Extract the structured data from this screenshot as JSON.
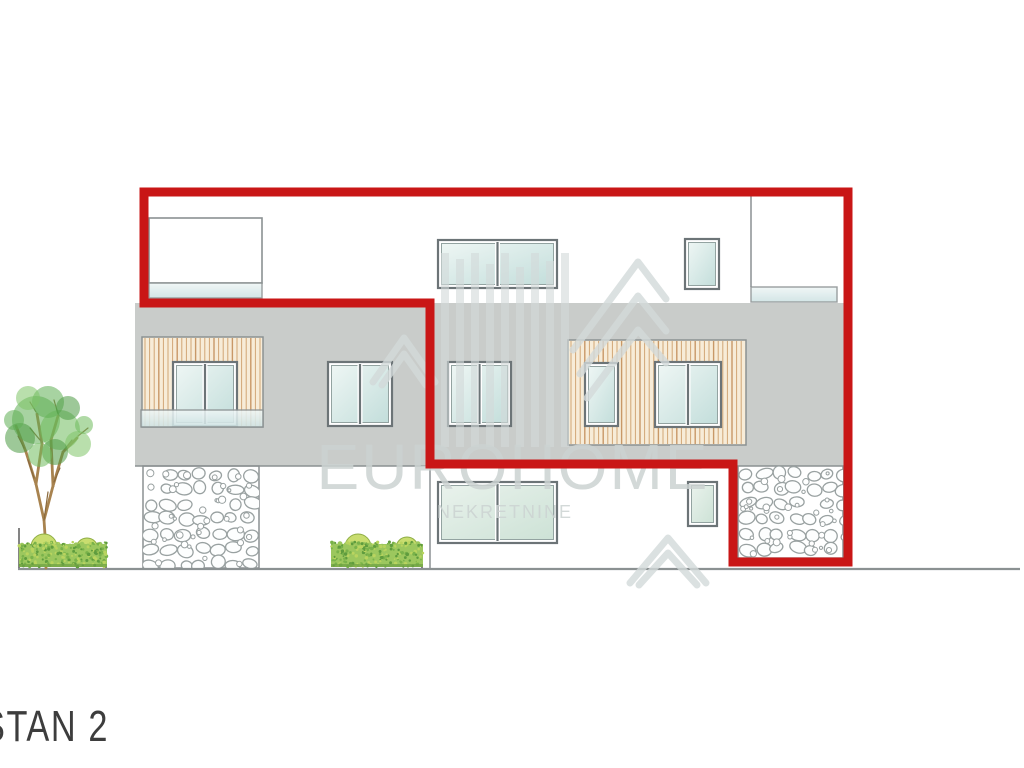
{
  "title_block": {
    "unit_label": "STAN 2"
  },
  "watermark": {
    "brand": "EUROHOME",
    "brand_sub": "NEKRETNINE"
  },
  "colors": {
    "red": "#c91616",
    "wall_gray": "#c9ccca",
    "wood_bg": "#f7ecd8",
    "wood_stripe": "#c58f55",
    "wood_stripe_dark": "#b97c42",
    "frame": "#6c7477",
    "line": "#8b9192",
    "stone": "#99a1a1",
    "dark_line": "#5a5a5a",
    "watermark_shape": "#d3dada",
    "hedge_base": "#9cc75e",
    "hedge_dark": "#5f9c3e",
    "hedge_light": "#b9d45f",
    "bush_fill": "#c9dd6f",
    "bush_stroke": "#8fae45",
    "trunk": "#a8834f",
    "twig": "#8a6a3e",
    "tree_greens": [
      "#5fae53",
      "#6fbb5d",
      "#4c9a44",
      "#7fc468"
    ]
  },
  "drawing": {
    "canvas": {
      "w": 1024,
      "h": 768
    },
    "walls": [
      {
        "name": "floor2-wall",
        "x": 135,
        "y": 303,
        "w": 710,
        "h": 163
      }
    ],
    "white_rects": [
      {
        "name": "attic-terrace-door",
        "x": 149,
        "y": 218,
        "w": 113,
        "h": 65
      }
    ],
    "wood_panels": [
      {
        "name": "wood-cladding-balcony",
        "x": 142,
        "y": 337,
        "w": 121,
        "h": 90
      },
      {
        "name": "wood-cladding-center",
        "x": 568,
        "y": 340,
        "w": 178,
        "h": 105
      }
    ],
    "windows": [
      {
        "name": "attic-window-center",
        "x": 438,
        "y": 240,
        "w": 119,
        "h": 48,
        "panes": 2,
        "glass": "g1"
      },
      {
        "name": "attic-window-small",
        "x": 685,
        "y": 239,
        "w": 34,
        "h": 50,
        "panes": 1,
        "glass": "g1"
      },
      {
        "name": "floor2-window-balcony",
        "x": 173,
        "y": 362,
        "w": 64,
        "h": 64,
        "panes": 2,
        "glass": "g1"
      },
      {
        "name": "floor2-window-left",
        "x": 328,
        "y": 362,
        "w": 64,
        "h": 64,
        "panes": 2,
        "glass": "g1"
      },
      {
        "name": "floor2-window-mid",
        "x": 448,
        "y": 362,
        "w": 63,
        "h": 64,
        "panes": 2,
        "glass": "g1"
      },
      {
        "name": "floor2-window-wood-small",
        "x": 585,
        "y": 363,
        "w": 33,
        "h": 63,
        "panes": 1,
        "glass": "g1"
      },
      {
        "name": "floor2-window-wood-large",
        "x": 655,
        "y": 362,
        "w": 66,
        "h": 65,
        "panes": 2,
        "glass": "g1"
      },
      {
        "name": "ground-window-large",
        "x": 438,
        "y": 482,
        "w": 119,
        "h": 61,
        "panes": 2,
        "glass": "g2"
      },
      {
        "name": "ground-window-small",
        "x": 688,
        "y": 482,
        "w": 29,
        "h": 44,
        "panes": 1,
        "glass": "g2"
      }
    ],
    "railings": [
      {
        "name": "glass-railing-attic-left",
        "x": 149,
        "y": 283,
        "w": 113,
        "h": 15
      },
      {
        "name": "glass-railing-attic-right",
        "x": 751,
        "y": 287,
        "w": 86,
        "h": 15
      },
      {
        "name": "glass-railing-balcony",
        "x": 141,
        "y": 410,
        "w": 122,
        "h": 17
      }
    ],
    "stones": [
      {
        "name": "stone-pillar-left",
        "x": 143,
        "y": 466,
        "w": 116,
        "h": 102
      },
      {
        "name": "stone-base-right",
        "x": 738,
        "y": 466,
        "w": 105,
        "h": 92
      }
    ],
    "lines": [
      {
        "name": "attic-divider-line",
        "x1": 751,
        "y1": 193,
        "x2": 751,
        "y2": 287,
        "w": 1.5
      },
      {
        "name": "floor-slab-edge-line",
        "x1": 135,
        "y1": 466,
        "x2": 426,
        "y2": 466,
        "w": 1.5
      },
      {
        "name": "ground-floor-corner-line",
        "x1": 430,
        "y1": 467,
        "x2": 430,
        "y2": 568,
        "w": 1.5
      },
      {
        "name": "ground-line",
        "x1": 18,
        "y1": 569,
        "x2": 1020,
        "y2": 569,
        "w": 2.2
      },
      {
        "name": "planter-edge-left",
        "x1": 19,
        "y1": 528,
        "x2": 19,
        "y2": 568,
        "w": 1.5,
        "color": "#5a5a5a"
      },
      {
        "name": "planter-edge-right",
        "x1": 106,
        "y1": 548,
        "x2": 106,
        "y2": 568,
        "w": 1.5,
        "color": "#5a5a5a"
      },
      {
        "name": "planter-edge-hedge2",
        "x1": 422,
        "y1": 548,
        "x2": 422,
        "y2": 568,
        "w": 1.5,
        "color": "#5a5a5a"
      }
    ],
    "tree": {
      "trunk": [
        [
          46,
          568,
          45,
          535
        ],
        [
          45,
          535,
          44,
          520
        ],
        [
          44,
          520,
          36,
          484
        ],
        [
          44,
          520,
          53,
          486
        ],
        [
          36,
          484,
          26,
          452
        ],
        [
          36,
          484,
          42,
          444
        ],
        [
          53,
          486,
          63,
          452
        ],
        [
          53,
          486,
          51,
          440
        ],
        [
          26,
          452,
          16,
          426
        ],
        [
          42,
          444,
          37,
          414
        ],
        [
          63,
          452,
          77,
          438
        ],
        [
          51,
          440,
          58,
          416
        ]
      ],
      "twigs": [
        [
          44,
          520,
          48,
          492
        ],
        [
          34,
          478,
          28,
          460
        ],
        [
          54,
          482,
          60,
          468
        ],
        [
          40,
          440,
          30,
          428
        ],
        [
          58,
          414,
          54,
          400
        ],
        [
          24,
          448,
          18,
          436
        ],
        [
          78,
          436,
          88,
          428
        ],
        [
          36,
          412,
          30,
          402
        ],
        [
          64,
          450,
          72,
          440
        ]
      ],
      "foliage": [
        [
          36,
          420,
          24,
          0
        ],
        [
          60,
          430,
          20,
          1
        ],
        [
          20,
          438,
          15,
          2
        ],
        [
          78,
          444,
          13,
          3
        ],
        [
          48,
          402,
          16,
          0
        ],
        [
          68,
          408,
          12,
          2
        ],
        [
          28,
          398,
          12,
          3
        ],
        [
          14,
          420,
          10,
          0
        ],
        [
          84,
          425,
          9,
          1
        ],
        [
          55,
          452,
          13,
          2
        ],
        [
          40,
          455,
          12,
          1
        ]
      ]
    },
    "hedges": [
      {
        "name": "hedge-left",
        "x": 19,
        "y": 544,
        "w": 88,
        "h": 23,
        "bushes": [
          [
            44,
            547,
            13
          ],
          [
            87,
            549,
            11
          ]
        ]
      },
      {
        "name": "hedge-right",
        "x": 331,
        "y": 544,
        "w": 92,
        "h": 23,
        "bushes": [
          [
            358,
            547,
            13
          ],
          [
            407,
            548,
            11
          ]
        ]
      }
    ],
    "red_outline": {
      "width": 9,
      "points": [
        [
          144,
          192
        ],
        [
          848,
          192
        ],
        [
          848,
          562
        ],
        [
          733,
          562
        ],
        [
          733,
          464
        ],
        [
          430,
          464
        ],
        [
          430,
          303
        ],
        [
          144,
          303
        ]
      ]
    },
    "watermark_marks": {
      "bars": {
        "x0": 441,
        "pitch": 15,
        "bw": 8,
        "tops": [
          253,
          259,
          253,
          264,
          253,
          267,
          253,
          261,
          253
        ],
        "bottom": 447
      },
      "chevrons": [
        [
          [
            573,
            350
          ],
          [
            638,
            262
          ],
          [
            666,
            299
          ]
        ],
        [
          [
            580,
            374
          ],
          [
            638,
            296
          ],
          [
            666,
            331
          ]
        ],
        [
          [
            587,
            398
          ],
          [
            638,
            330
          ],
          [
            666,
            363
          ]
        ],
        [
          [
            373,
            382
          ],
          [
            404,
            338
          ],
          [
            435,
            382
          ]
        ],
        [
          [
            382,
            385
          ],
          [
            404,
            354
          ],
          [
            426,
            385
          ]
        ],
        [
          [
            630,
            583
          ],
          [
            668,
            538
          ],
          [
            706,
            583
          ]
        ],
        [
          [
            639,
            585
          ],
          [
            668,
            553
          ],
          [
            697,
            585
          ]
        ]
      ]
    }
  }
}
